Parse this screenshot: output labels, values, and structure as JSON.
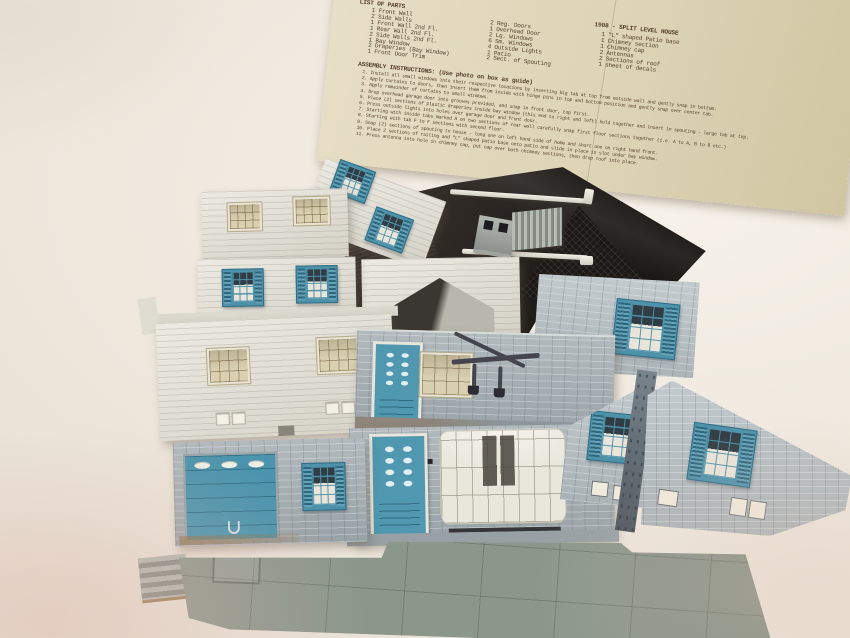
{
  "instruction_sheet": {
    "parts_header": "LIST OF PARTS",
    "kit_title": "1908 - SPLIT LEVEL HOUSE",
    "columns": {
      "col1": [
        "1 Front Wall",
        "2 Side Walls",
        "1 Front Wall 2nd Fl.",
        "1 Rear Wall 2nd Fl.",
        "2 Side Walls 2nd Fl.",
        "1 Bay Window",
        "2 Draperies (Bay Window)",
        "1 Front Door Trim"
      ],
      "col2": [
        "2 Reg. Doors",
        "1 Overhead Door",
        "2 Lg. Windows",
        "6 Sm. Windows",
        "4 Outside Lights",
        "1 Patio",
        "2 Sect. of Spouting"
      ],
      "col3": [
        "1 \"L\" shaped Patio base",
        "1 Chimney section",
        "1 Chimney cap",
        "2 Antennas",
        "2 Sections of roof",
        "1 sheet of decals"
      ]
    },
    "assembly_header": "ASSEMBLY INSTRUCTIONS: (Use photo on box as guide)",
    "assembly_steps": [
      "1.  Install all small windows into their respective locations by inserting big tab at top from outside wall and gently snap in bottom.",
      "2.  Apply curtains to doors, then insert them from inside with hinge pins in top and bottom position and gently snap over center tab.",
      "3.  Apply remainder of curtains to small windows.",
      "4.  Drop overhead garage door into grooves provided, and snap in front door, top first.",
      "5.  Place (2) sections of plastic draperies inside bay window (this end to right and left) hold together and insert in spouting - large tab at top.",
      "6.  Press outside lights into holes over garage door and front door.",
      "7.  Starting with inside tabs marked A on two sections of rear wall carefully snap first floor sections together (i.e. A to A, B to B etc.)",
      "8.  Starting with tab F to F sections with second floor.",
      "9.  Snap (2) sections of spouting to house - long one on left hand side of home and short one on right hand front.",
      "10. Place 2 sections of railing and \"L\" shaped patio base onto patio and slide in place in slot under bay window.",
      "11. Press antenna into hole in chimney cap, put cap over both chimney sections, then drop roof into place."
    ]
  },
  "palette": {
    "background_cloth": "#efe9df",
    "pink_cast": "#e0baae",
    "paper": "#ddd3b6",
    "typewriter_ink": "#55402e",
    "white_plastic": "#e6e3d9",
    "teal_plastic": "#4e92aa",
    "tan_window": "#d9d0b2",
    "stone_gray": "#a9b2b6",
    "stone_light_gray": "#bcc5c8",
    "dark_roof": "#221e1b",
    "patio_gray_green": "#8c978c",
    "accessory_gray": "#9aa09a"
  }
}
